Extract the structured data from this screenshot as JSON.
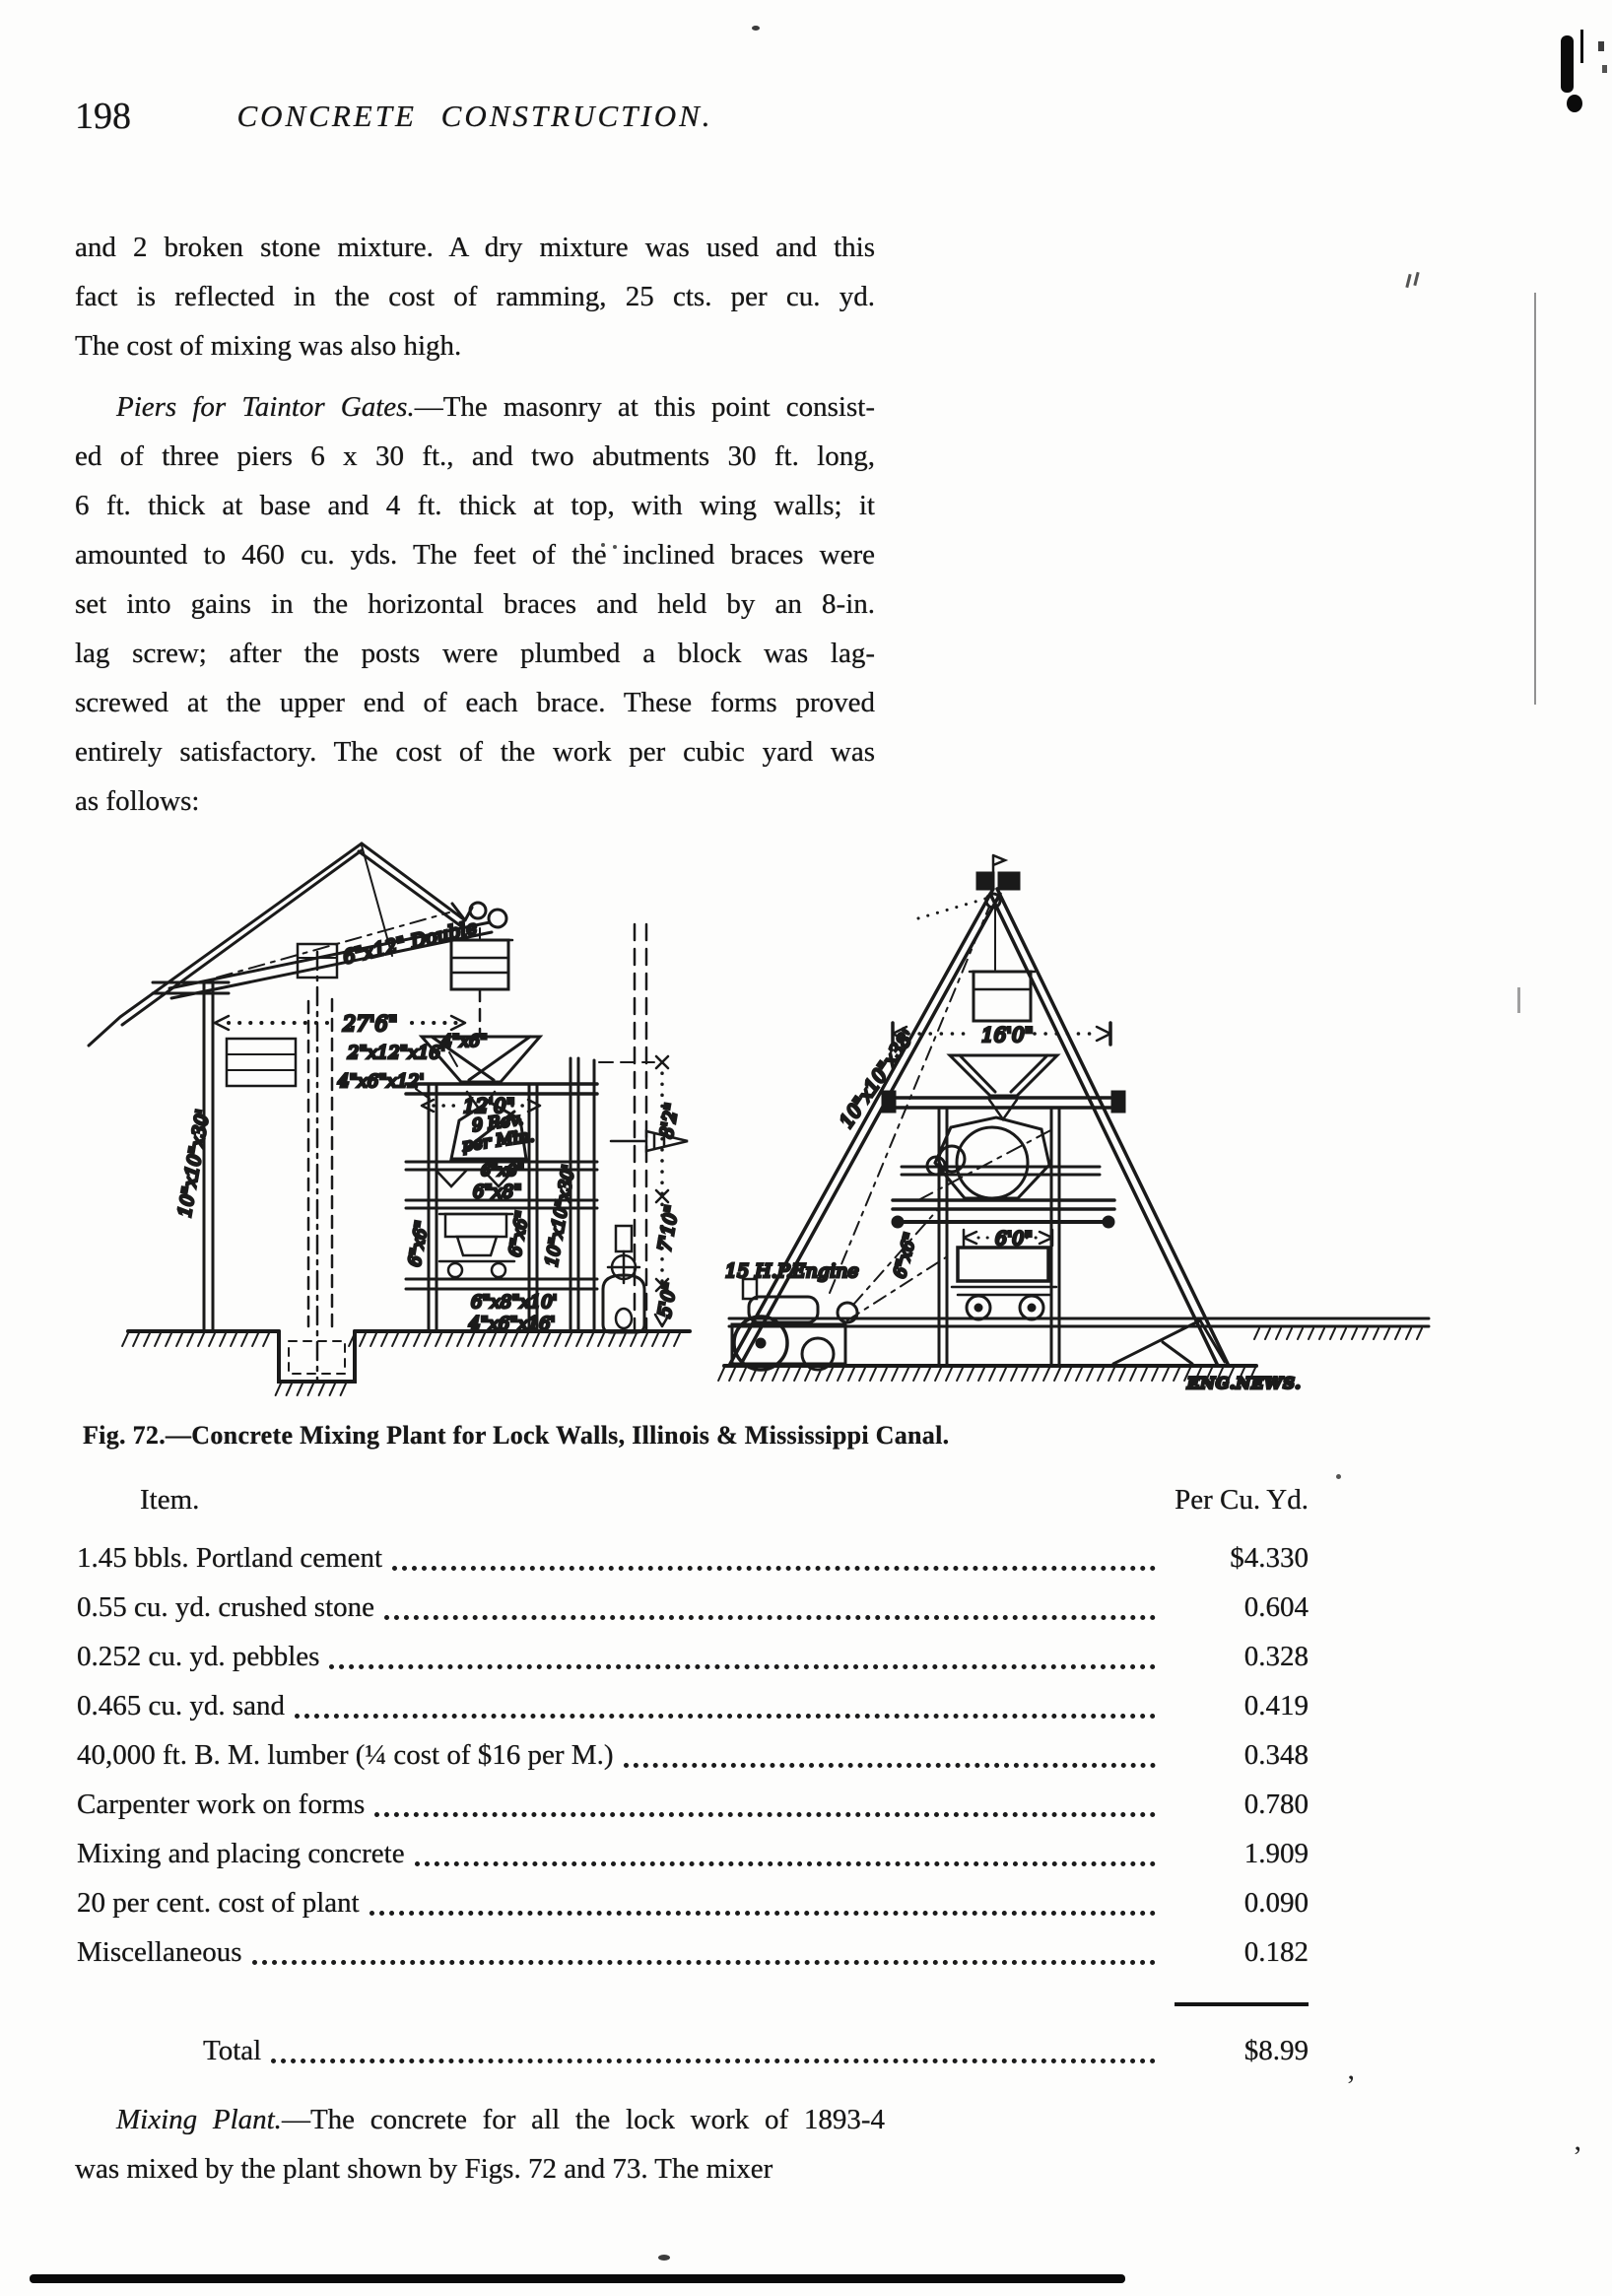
{
  "page": {
    "number": "198",
    "running_title": "CONCRETE CONSTRUCTION."
  },
  "para1": {
    "lines": [
      "and 2 broken stone mixture. A dry mixture was used and this",
      "fact is reflected in the cost of ramming, 25 cts. per cu. yd.",
      "The cost of mixing was also high."
    ]
  },
  "para2": {
    "lead_italic": "Piers for Taintor Gates.",
    "lead_rest": "—The masonry at this point consist-",
    "lines": [
      "ed of three piers 6 x 30 ft., and two abutments 30 ft. long,",
      "6 ft. thick at base and 4 ft. thick at top, with wing walls; it",
      "amounted to 460 cu. yds. The feet of the inclined braces were",
      "set into gains in the horizontal braces and held by an 8-in.",
      "lag screw; after the posts were plumbed a block was lag-",
      "screwed at the upper end of each brace. These forms proved",
      "entirely satisfactory. The cost of the work per cubic yard was",
      "as follows:"
    ]
  },
  "figure": {
    "caption": "Fig. 72.—Concrete Mixing Plant for Lock Walls, Illinois & Mississippi Canal.",
    "credit": "ENG.NEWS.",
    "labels": {
      "boom": "6\"x12\" Double",
      "dim276": "27'6\"",
      "s2x12x16": "2\"x12\"x16'",
      "s4x6x12": "4\"x6\"x12'",
      "s4x6": "4\"x6\"",
      "dim120": "12'0\"",
      "rev9": "9 Rev.",
      "permin": "per Min.",
      "s6x8a": "6\"x8\"",
      "s6x8b": "6\"x8\"",
      "s6x6a": "6\"x6\"",
      "s6x6b": "6\"x6\"",
      "s10x10x30a": "10\"x10\"x30'",
      "s10x10x30b": "10\"x10\"x30'",
      "dim82": "8'2\"",
      "dim710": "7'10\"",
      "dim50": "5'0\"",
      "s6x8x10": "6\"x8\"x10'",
      "s4x6x16": "4\"x6\"x16'",
      "dim160": "16'0\"",
      "s10x10x38": "10\"x10\"x38'",
      "engine": "15 H.P.Engine",
      "s6x6r": "6\"x6\"",
      "dim60": "6'0\""
    }
  },
  "cost_table": {
    "header": {
      "item": "Item.",
      "value": "Per Cu. Yd."
    },
    "rows": [
      {
        "item": "1.45 bbls. Portland cement",
        "value": "$4.330"
      },
      {
        "item": "0.55 cu. yd. crushed stone",
        "value": "0.604"
      },
      {
        "item": "0.252 cu. yd. pebbles",
        "value": "0.328"
      },
      {
        "item": "0.465 cu. yd. sand",
        "value": "0.419"
      },
      {
        "item": "40,000 ft. B. M. lumber (¼ cost of $16 per M.)",
        "value": "0.348"
      },
      {
        "item": "Carpenter work on forms",
        "value": "0.780"
      },
      {
        "item": "Mixing and placing concrete",
        "value": "1.909"
      },
      {
        "item": "20 per cent. cost of plant",
        "value": "0.090"
      },
      {
        "item": "Miscellaneous",
        "value": "0.182"
      }
    ],
    "total": {
      "label": "Total",
      "value": "$8.99"
    }
  },
  "para3": {
    "lead_italic": "Mixing Plant.",
    "lead_rest": "—The concrete for all the lock work of 1893-4",
    "line2": "was mixed by the plant shown by Figs. 72 and 73. The mixer"
  },
  "artifacts": {
    "quote1": "’",
    "quote2": "’"
  }
}
